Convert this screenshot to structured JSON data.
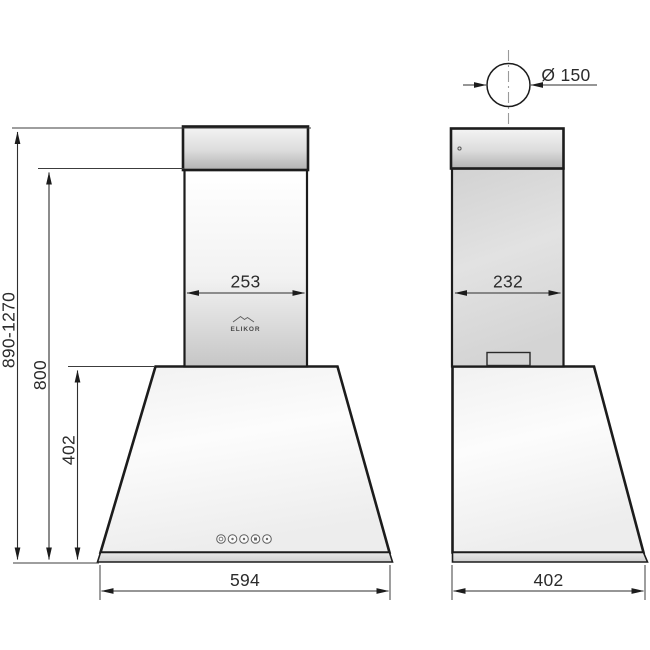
{
  "drawing": {
    "type": "range-hood-dimension-drawing",
    "brand": "ELIKOR",
    "heights": {
      "total_range_mm": "890-1270",
      "to_chimney_top_mm": "800",
      "body_height_mm": "402"
    },
    "front_view": {
      "chimney_width_mm": "253",
      "body_width_mm": "594",
      "control_buttons_count": 5
    },
    "side_view": {
      "chimney_depth_mm": "232",
      "body_depth_mm": "402",
      "duct_diameter": "Ø 150"
    },
    "colors": {
      "outline": "#1c1c1c",
      "dimension_line": "#2e2e2e",
      "centerline": "#9a9a9a",
      "metal_light": "#f7f7f7",
      "metal_dark": "#b2b2b2",
      "chimney_gray": "#d7d7d7",
      "body_white": "#fafafa",
      "background": "#ffffff"
    }
  }
}
